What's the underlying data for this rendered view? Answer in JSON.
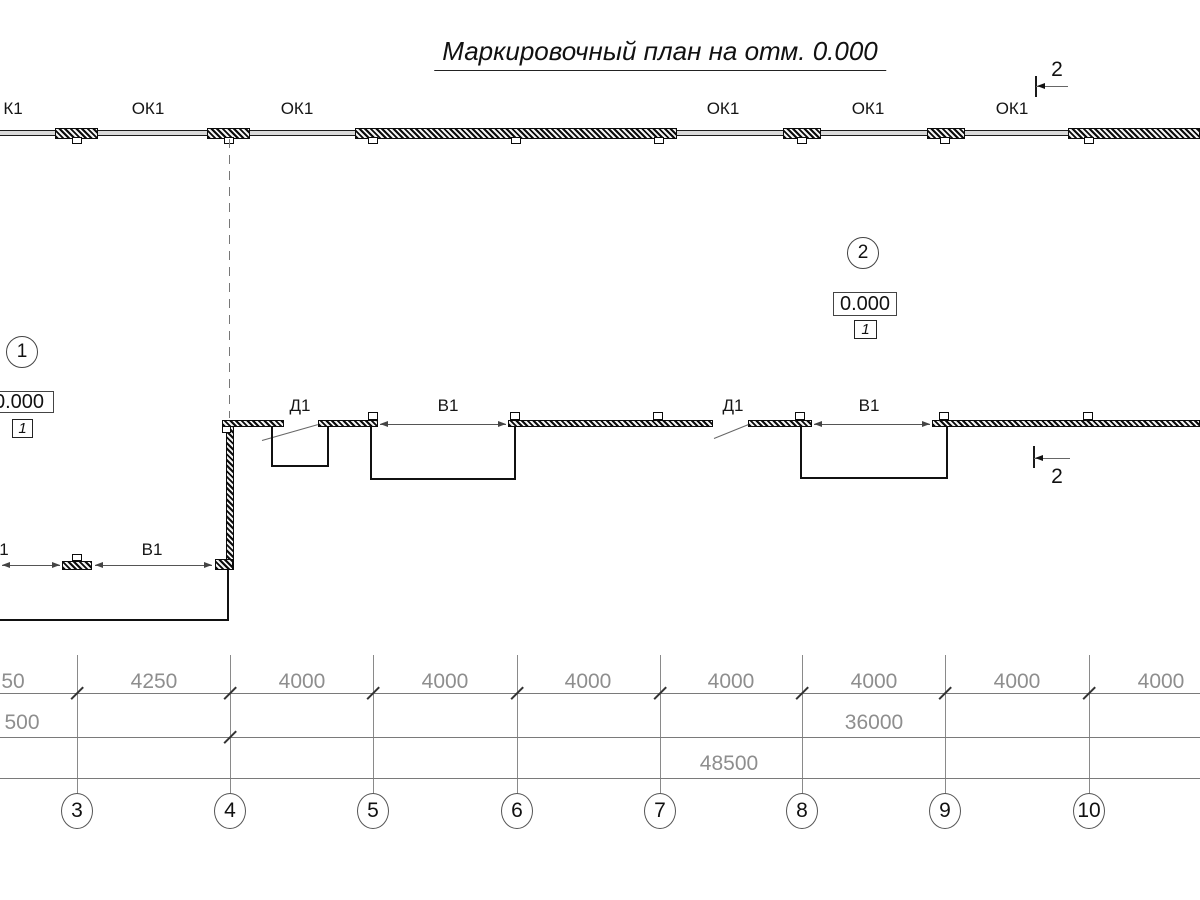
{
  "title": "Маркировочный план на отм. 0.000",
  "colors": {
    "ink": "#141414",
    "dim_text": "#8e8e8e",
    "dim_line": "#7a7a7a",
    "band_fill": "#d9d9d9"
  },
  "top_wall": {
    "band": {
      "y": 130,
      "h": 6
    },
    "piers": [
      [
        55,
        43
      ],
      [
        207,
        43
      ],
      [
        355,
        322
      ],
      [
        783,
        38
      ],
      [
        927,
        38
      ],
      [
        1068,
        132
      ]
    ],
    "tabs": [
      77,
      229,
      373,
      516,
      659,
      802,
      945,
      1089
    ],
    "label_y": 99,
    "labels": [
      {
        "t": "К1",
        "x": 13
      },
      {
        "t": "ОК1",
        "x": 148
      },
      {
        "t": "ОК1",
        "x": 297
      },
      {
        "t": "ОК1",
        "x": 723
      },
      {
        "t": "ОК1",
        "x": 868
      },
      {
        "t": "ОК1",
        "x": 1012
      }
    ]
  },
  "dashed_axis": {
    "x": 229,
    "y": 139,
    "h": 279
  },
  "mid_wall": {
    "y": 420,
    "h": 7,
    "segments": [
      [
        222,
        62
      ],
      [
        318,
        60
      ],
      [
        508,
        205
      ],
      [
        748,
        64
      ],
      [
        932,
        268
      ]
    ],
    "tabs": [
      373,
      515,
      658,
      800,
      944,
      1088
    ],
    "vertical": {
      "x": 226,
      "y": 426,
      "w": 8,
      "h": 144
    },
    "corner": {
      "x": 215,
      "y": 559,
      "w": 18,
      "h": 11
    },
    "lower_pier": {
      "x": 62,
      "y": 561,
      "w": 30,
      "h": 9
    },
    "lower_tab": {
      "x": 72,
      "y": 554,
      "w": 10,
      "h": 7
    },
    "corner_tab": {
      "x": 222,
      "y": 426,
      "w": 9,
      "h": 7
    }
  },
  "doors": [
    {
      "label": "Д1",
      "lx": 300,
      "ly": 396,
      "x": 262,
      "y": 440,
      "len": 58,
      "angle": -15.9
    },
    {
      "label": "Д1",
      "lx": 733,
      "ly": 396,
      "x": 714,
      "y": 438,
      "len": 37,
      "angle": -22.0
    }
  ],
  "gates": [
    {
      "label": "В1",
      "lx": 448,
      "ly": 396,
      "x1": 380,
      "x2": 506,
      "y": 424
    },
    {
      "label": "В1",
      "lx": 869,
      "ly": 396,
      "x1": 814,
      "x2": 930,
      "y": 424
    },
    {
      "label": "1",
      "lx": 4,
      "ly": 540,
      "x1": 2,
      "x2": 60,
      "y": 565
    },
    {
      "label": "В1",
      "lx": 152,
      "ly": 540,
      "x1": 95,
      "x2": 212,
      "y": 565
    }
  ],
  "recesses": [
    {
      "x": 271,
      "y": 427,
      "w": 58,
      "h": 40
    },
    {
      "x": 370,
      "y": 427,
      "w": 146,
      "h": 53
    },
    {
      "x": 800,
      "y": 427,
      "w": 148,
      "h": 52
    }
  ],
  "platform": {
    "x": -4,
    "y": 570,
    "w": 233,
    "h": 51
  },
  "section_marks": [
    {
      "digit": "2",
      "bar_x": 1035,
      "bar_y": 76,
      "bar_h": 21,
      "line_x": 1036,
      "line_y": 86,
      "line_w": 32,
      "digit_x": 1057,
      "digit_y": 58
    },
    {
      "digit": "2",
      "bar_x": 1033,
      "bar_y": 446,
      "bar_h": 22,
      "line_x": 1034,
      "line_y": 458,
      "line_w": 36,
      "digit_x": 1057,
      "digit_y": 465
    }
  ],
  "markers": [
    {
      "circle": "1",
      "cx": 22,
      "cy": 352,
      "r": 16,
      "elev": "0.000",
      "ebox": [
        -16,
        391,
        70,
        22
      ],
      "tag": "1",
      "tbox": [
        12,
        419,
        21,
        19
      ]
    },
    {
      "circle": "2",
      "cx": 863,
      "cy": 253,
      "r": 16,
      "elev": "0.000",
      "ebox": [
        833,
        292,
        64,
        24
      ],
      "tag": "1",
      "tbox": [
        854,
        320,
        23,
        19
      ]
    }
  ],
  "dimensions": {
    "grid_lines": {
      "xs": [
        77,
        230,
        373,
        517,
        660,
        802,
        945,
        1089
      ],
      "y1": 655,
      "y2": 794
    },
    "rows": [
      {
        "y": 693,
        "label_y": 670,
        "ticks": [
          77,
          230,
          373,
          517,
          660,
          802,
          945,
          1089
        ],
        "labels": [
          {
            "t": "50",
            "x": 13
          },
          {
            "t": "4250",
            "x": 154
          },
          {
            "t": "4000",
            "x": 302
          },
          {
            "t": "4000",
            "x": 445
          },
          {
            "t": "4000",
            "x": 588
          },
          {
            "t": "4000",
            "x": 731
          },
          {
            "t": "4000",
            "x": 874
          },
          {
            "t": "4000",
            "x": 1017
          },
          {
            "t": "4000",
            "x": 1161
          }
        ]
      },
      {
        "y": 737,
        "label_y": 711,
        "ticks": [
          230
        ],
        "labels": [
          {
            "t": "500",
            "x": 22
          },
          {
            "t": "36000",
            "x": 874
          }
        ]
      },
      {
        "y": 778,
        "label_y": 752,
        "ticks": [],
        "labels": [
          {
            "t": "48500",
            "x": 729
          }
        ]
      }
    ]
  },
  "grid_bubbles": {
    "cy": 811,
    "rx": 16,
    "ry": 18,
    "items": [
      {
        "n": "3",
        "x": 77
      },
      {
        "n": "4",
        "x": 230
      },
      {
        "n": "5",
        "x": 373
      },
      {
        "n": "6",
        "x": 517
      },
      {
        "n": "7",
        "x": 660
      },
      {
        "n": "8",
        "x": 802
      },
      {
        "n": "9",
        "x": 945
      },
      {
        "n": "10",
        "x": 1089
      }
    ]
  }
}
